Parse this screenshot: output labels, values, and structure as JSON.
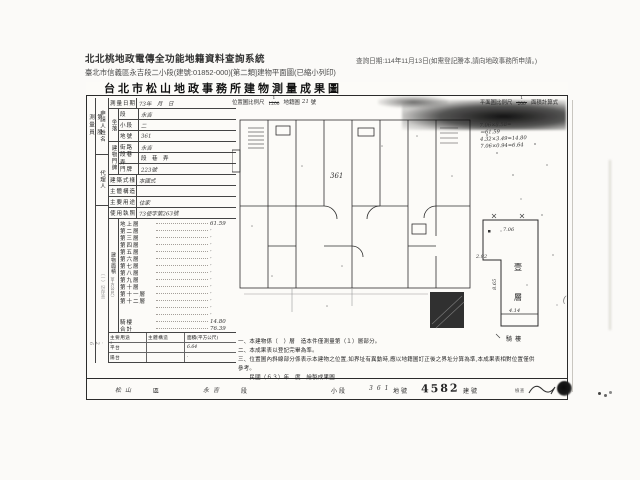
{
  "app": {
    "title": "北北桃地政電傳全功能地籍資料查詢系統",
    "subtitle": "臺北市信義區永吉段二小段(建號:01852-000)[第二類]建物平面圖(已縮小列印)",
    "query_note": "查詢日期:114年11月13日(如需登記謄本,請向地政事務所申請。)"
  },
  "doc": {
    "title": "台北市松山地政事務所建物測量成果圖",
    "margin": {
      "section": "第　股",
      "surveyor": "測量員",
      "file_note": "（一）份存查",
      "file_date": "7.26"
    },
    "form": {
      "applicant_label": "申請人姓名",
      "agent_label": "代理人",
      "survey_date": {
        "label": "測量日期",
        "value": "73年　月　日"
      },
      "location": {
        "label": "坐落",
        "rows": [
          {
            "label": "段",
            "value": "永吉"
          },
          {
            "label": "小段",
            "value": "二"
          },
          {
            "label": "地號",
            "value": "361"
          }
        ]
      },
      "address": {
        "label": "建物門牌",
        "rows": [
          {
            "label": "街路",
            "value": "永吉"
          },
          {
            "label": "段巷弄",
            "value": "段　巷　弄"
          },
          {
            "label": "門牌",
            "value": "223號"
          }
        ]
      },
      "style": {
        "label": "建築式樣",
        "value": "本國式"
      },
      "structure": {
        "label": "主體構造",
        "value": ""
      },
      "usage": {
        "label": "主要用途",
        "value": "住家"
      },
      "license": {
        "label": "使用執照",
        "value": "73使字第263號"
      },
      "area": {
        "label": "建物面積",
        "unit": "（平方公尺）",
        "floors": [
          {
            "label": "地上層",
            "value": "61.59"
          },
          {
            "label": "第二層",
            "value": "·"
          },
          {
            "label": "第三層",
            "value": "·"
          },
          {
            "label": "第四層",
            "value": "·"
          },
          {
            "label": "第五層",
            "value": "·"
          },
          {
            "label": "第六層",
            "value": "·"
          },
          {
            "label": "第七層",
            "value": "·"
          },
          {
            "label": "第八層",
            "value": "·"
          },
          {
            "label": "第九層",
            "value": "·"
          },
          {
            "label": "第十層",
            "value": "·"
          },
          {
            "label": "第十一層",
            "value": "·"
          },
          {
            "label": "第十二層",
            "value": "·"
          },
          {
            "label": "",
            "value": "·"
          },
          {
            "label": "",
            "value": "·"
          },
          {
            "label": "騎樓",
            "value": "14.80"
          },
          {
            "label": "合計",
            "value": "76.39"
          }
        ]
      },
      "annex": {
        "headers": [
          "主要用途",
          "主體構造",
          "面積(平方公尺)"
        ],
        "rows": [
          {
            "usage": "平台",
            "structure": "",
            "area": "6.64"
          },
          {
            "usage": "陽台",
            "structure": "",
            "area": "·"
          }
        ]
      }
    },
    "plan": {
      "scale_left": {
        "prefix": "位置圖比例尺",
        "num": "1",
        "den": "1200",
        "map": "地籍圖",
        "no": "21",
        "unit": "號"
      },
      "scale_right": {
        "prefix": "平面圖比例尺",
        "num": "1",
        "den": "200",
        "calc": "面積計算式"
      },
      "plot_label": "361",
      "calc_lines": [
        "7.06×8.58=",
        "＝61.59",
        "4.32×3.49=14.80",
        "7.06×0.94=6.64"
      ]
    },
    "unit_plan": {
      "dim_top": "7.06",
      "dim_left": "2.92",
      "dim_height": "8.65",
      "dim_bottom": "4.14",
      "floor_char1": "壹",
      "floor_char2": "層",
      "arcade": "騎樓"
    },
    "notes": [
      "一、本建物係（　）層　造本件僅測量第（１）層部分。",
      "二、本成果表以登記完畢為準。",
      "三、位置圖內斜線部分係表示本建物之位置,如界址有異動時,應以地籍圖訂正後之界址分算為準,本成果表相對位置僅供參考。",
      "　　民國（６３）年　度　繪製成果圖"
    ],
    "footer": {
      "district": "松山",
      "district_unit": "區",
      "section": "永吉",
      "section_unit": "段",
      "subsection_unit": "小段",
      "parcel": "361",
      "parcel_unit": "地號",
      "building_no": "4582",
      "building_unit": "建號",
      "check_label": "檢查"
    }
  }
}
